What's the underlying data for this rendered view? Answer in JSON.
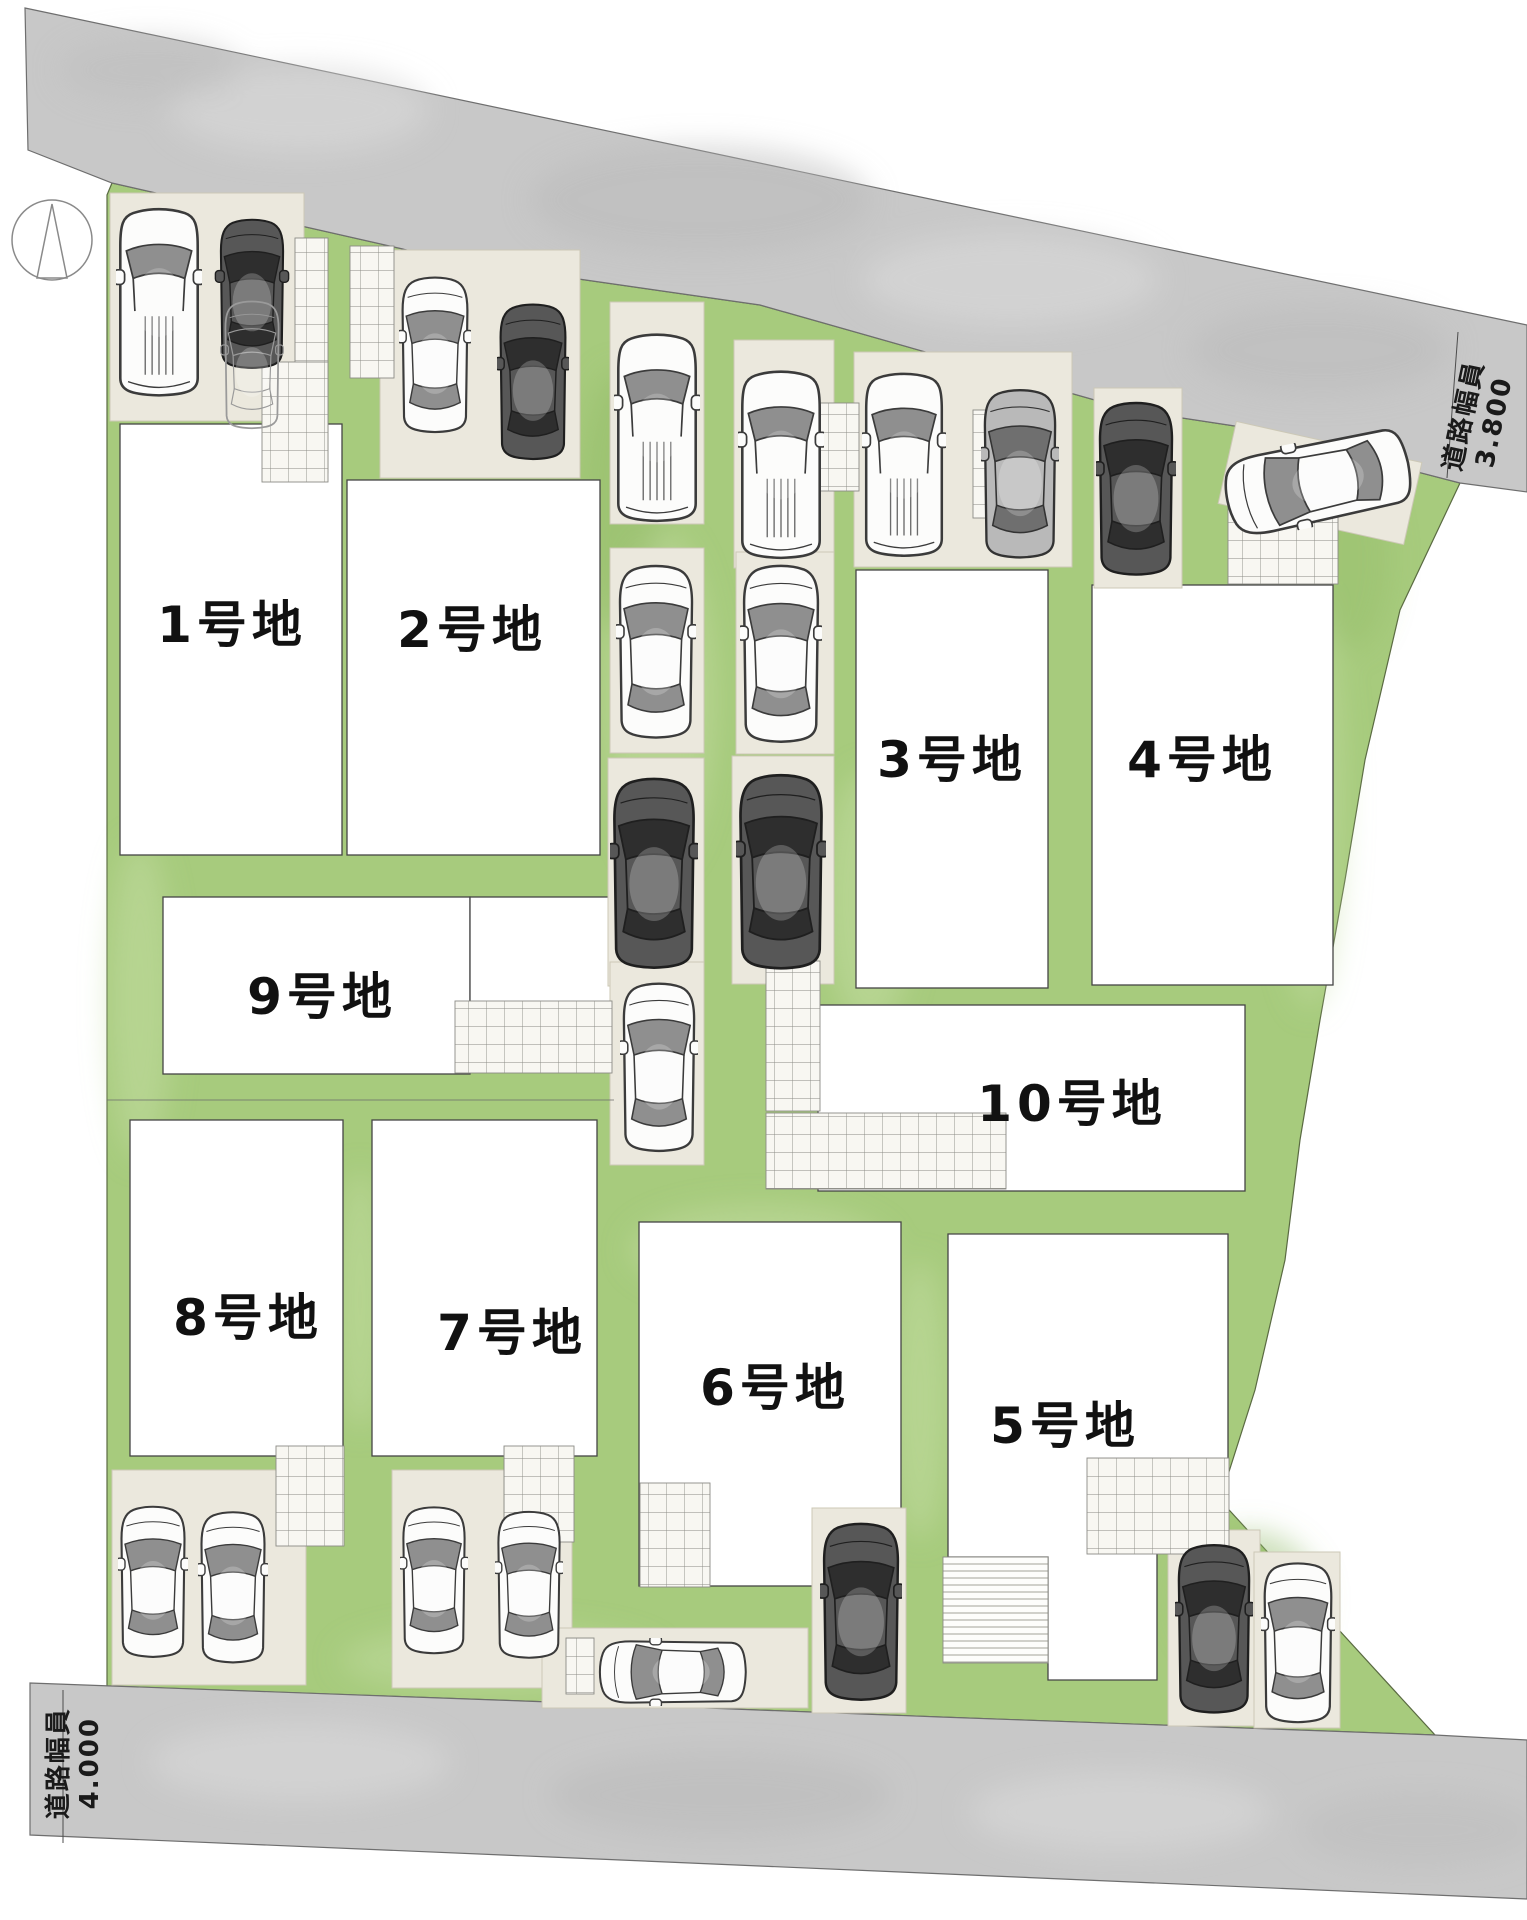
{
  "plan": {
    "type": "residential-subdivision-site-plan",
    "lot_count": 10
  },
  "roads": {
    "top": {
      "label": "道路幅員",
      "value": "3.800"
    },
    "bottom": {
      "label": "道路幅員",
      "value": "4.000"
    }
  },
  "lots": [
    {
      "id": 1,
      "label": "1号地"
    },
    {
      "id": 2,
      "label": "2号地"
    },
    {
      "id": 3,
      "label": "3号地"
    },
    {
      "id": 4,
      "label": "4号地"
    },
    {
      "id": 5,
      "label": "5号地"
    },
    {
      "id": 6,
      "label": "6号地"
    },
    {
      "id": 7,
      "label": "7号地"
    },
    {
      "id": 8,
      "label": "8号地"
    },
    {
      "id": 9,
      "label": "9号地"
    },
    {
      "id": 10,
      "label": "10号地"
    }
  ],
  "icons": {
    "compass": "north-arrow-compass"
  },
  "colors": {
    "road_gray": "#c8c8c8",
    "landscape_green": "#a7cb7d",
    "parking_pad_beige": "#ebe8dd",
    "lot_fill": "#ffffff",
    "outline": "#454545",
    "text": "#111111"
  }
}
